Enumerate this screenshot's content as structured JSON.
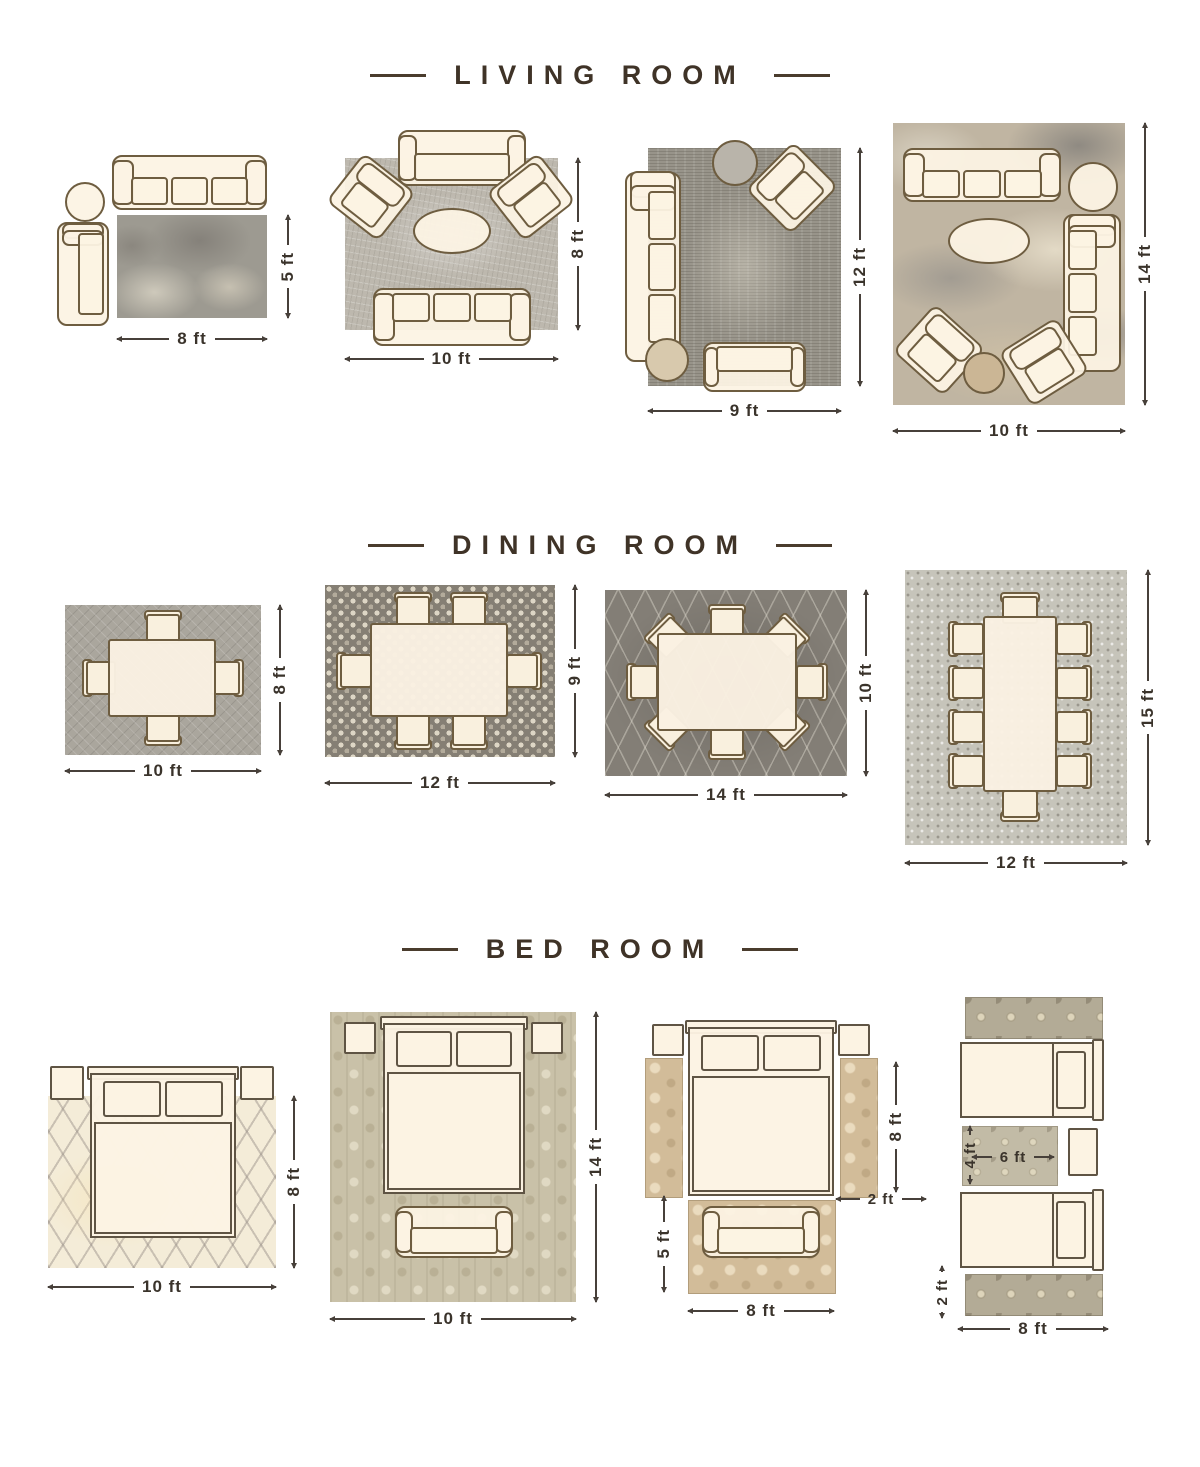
{
  "colors": {
    "title": "#3f3327",
    "dimension_text": "#3a332b",
    "furniture_outline": "#6e5d40",
    "furniture_fill": "#fcf3e3"
  },
  "sections": {
    "living_room": {
      "title": "LIVING ROOM",
      "layouts": [
        {
          "width_label": "8 ft",
          "height_label": "5 ft"
        },
        {
          "width_label": "10 ft",
          "height_label": "8 ft"
        },
        {
          "width_label": "9 ft",
          "height_label": "12 ft"
        },
        {
          "width_label": "10 ft",
          "height_label": "14 ft"
        }
      ]
    },
    "dining_room": {
      "title": "DINING ROOM",
      "layouts": [
        {
          "width_label": "10 ft",
          "height_label": "8 ft"
        },
        {
          "width_label": "12 ft",
          "height_label": "9 ft"
        },
        {
          "width_label": "14 ft",
          "height_label": "10 ft"
        },
        {
          "width_label": "12 ft",
          "height_label": "15 ft"
        }
      ]
    },
    "bed_room": {
      "title": "BED ROOM",
      "layouts": [
        {
          "width_label": "10 ft",
          "height_label": "8 ft"
        },
        {
          "width_label": "10 ft",
          "height_label": "14 ft"
        },
        {
          "runner_height_label": "8 ft",
          "runner_width_label": "2 ft",
          "foot_rug_height_label": "5 ft",
          "foot_rug_width_label": "8 ft"
        },
        {
          "center_rug_height_label": "4 ft",
          "center_rug_width_label": "6 ft",
          "runner_width_label": "2 ft",
          "runner_length_label": "8 ft"
        }
      ]
    }
  }
}
